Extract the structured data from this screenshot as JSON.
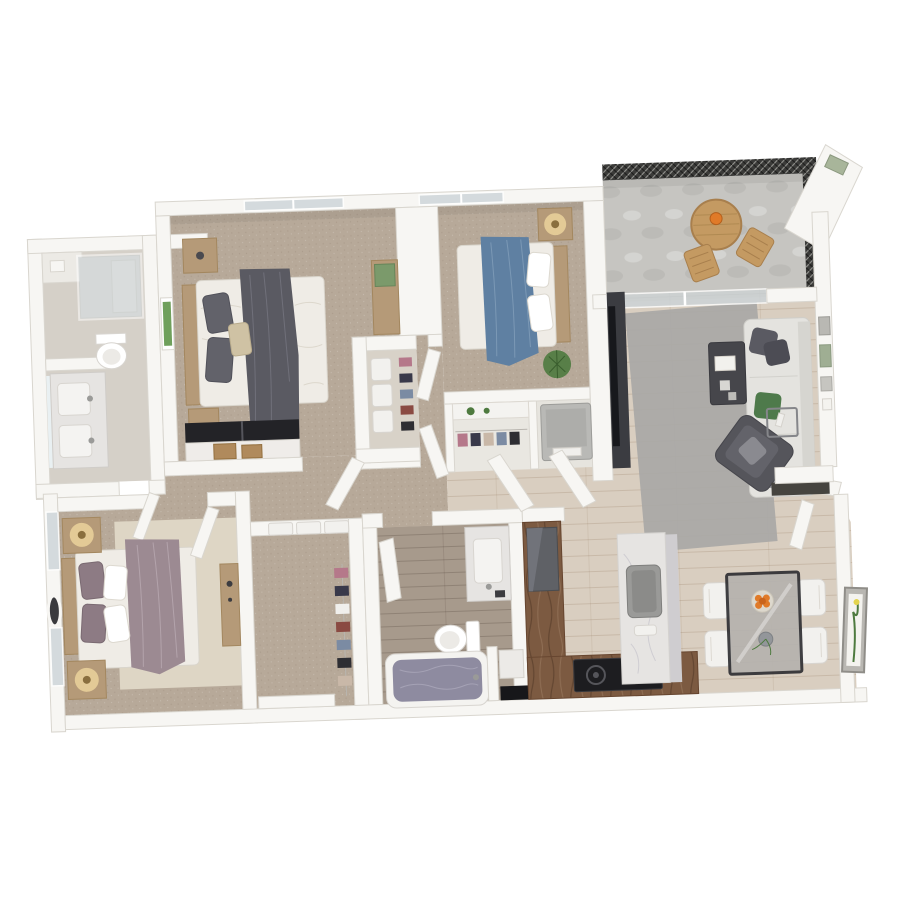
{
  "meta": {
    "type": "3d-floor-plan-render",
    "view": "top-down dollhouse",
    "background": "#ffffff",
    "visible_text": "none",
    "bedrooms": 3,
    "bathrooms": 2
  },
  "palette": {
    "wall": "#f7f6f3",
    "wallEdge": "#d9d6cf",
    "wallFace": "#e9e7e2",
    "carpet": "#b7a999",
    "wood": "#d9cec0",
    "tile": "#d5d0c8",
    "bathFloor": "#a79a8c",
    "concrete": "#c6c5c1",
    "walnut": "#7c5a41",
    "marble": "#e6e4e2",
    "glass": "#ccd4d8",
    "throwDark": "#5a5a62",
    "throwBlue": "#5f80a2",
    "throwMauve": "#9c8a92",
    "sofa": "#e4e3df",
    "rug": "#a9a8a6",
    "rugCream": "#ded6c5",
    "woodLight": "#b59a78",
    "green": "#4e7a3f",
    "orange": "#e07a28",
    "tv": "#17181c",
    "mesh": "#3b3b39",
    "lamp": "#f3d9a0",
    "washer": "#b9b9b6",
    "water": "#8e8ba0",
    "charcoal": "#4a4a4f"
  },
  "rooms": [
    {
      "id": "bedroom-1",
      "name": "Bedroom 1",
      "floor": "carpet",
      "furniture": [
        "queen-bed",
        "dark-gray-throw",
        "gray-pillows",
        "nightstand x2",
        "desk-with-pinboard",
        "wall-art",
        "sliding-door-closet",
        "window"
      ]
    },
    {
      "id": "bedroom-2",
      "name": "Bedroom 2",
      "floor": "carpet",
      "furniture": [
        "queen-bed",
        "blue-throw",
        "nightstand-with-lamp",
        "potted-plant",
        "closet",
        "window"
      ]
    },
    {
      "id": "master-bedroom",
      "name": "Master Bedroom",
      "floor": "carpet",
      "furniture": [
        "king-bed",
        "mauve-throw",
        "nightstand-with-lamp x2",
        "round-wall-mirror",
        "cream-rug",
        "wood-console",
        "windows"
      ]
    },
    {
      "id": "master-bathroom",
      "name": "Master Bathroom",
      "floor": "tile",
      "furniture": [
        "walk-in-shower",
        "toilet",
        "double-sink-vanity",
        "linen-niche"
      ]
    },
    {
      "id": "walk-in-closet",
      "name": "Walk-in Closet",
      "floor": "carpet",
      "furniture": [
        "storage-boxes",
        "hanging-clothes",
        "door"
      ]
    },
    {
      "id": "bathroom-2",
      "name": "Bathroom 2",
      "floor": "wood",
      "furniture": [
        "vanity-sink",
        "toilet",
        "bathtub",
        "storage-nook"
      ]
    },
    {
      "id": "hallway",
      "name": "Hallway",
      "floor": "carpet",
      "furniture": [
        "linen-closet",
        "laundry-closet-with-washer",
        "bedroom-2-closet"
      ]
    },
    {
      "id": "living-room",
      "name": "Living Room",
      "floor": "wood",
      "furniture": [
        "sofa-with-pillows",
        "area-rug",
        "coffee-table",
        "armchair",
        "glass-side-table",
        "tv-on-console",
        "wall-frames"
      ]
    },
    {
      "id": "kitchen",
      "name": "Kitchen",
      "floor": "wood",
      "furniture": [
        "l-shaped-walnut-counter",
        "refrigerator",
        "cooktop",
        "marble-island-with-sink"
      ]
    },
    {
      "id": "dining",
      "name": "Dining Area",
      "floor": "wood",
      "furniture": [
        "glass-table",
        "white-chair x4",
        "fruit-bowl",
        "vase",
        "wall-art"
      ]
    },
    {
      "id": "balcony",
      "name": "Balcony",
      "floor": "concrete",
      "furniture": [
        "round-wood-table",
        "wood-chair x2",
        "mesh-railing",
        "sliding-glass-door"
      ]
    }
  ]
}
